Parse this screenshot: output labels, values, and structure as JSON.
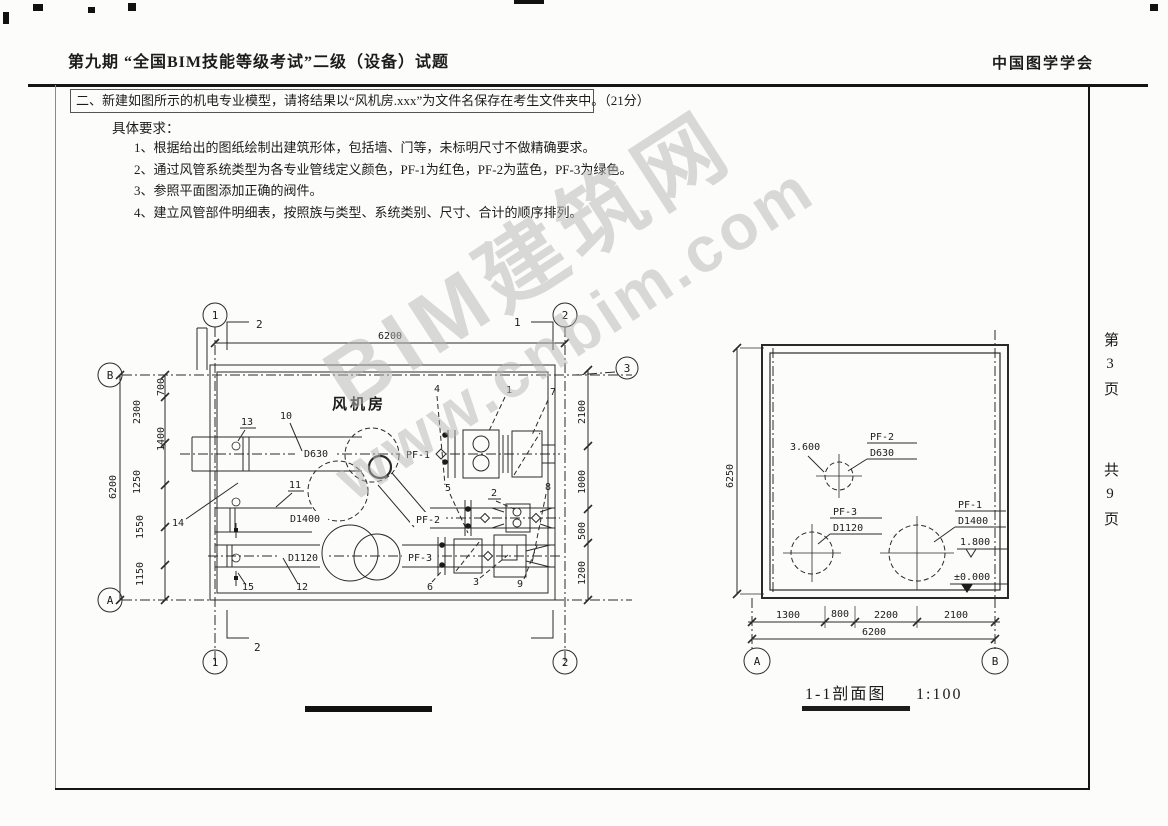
{
  "header": {
    "title": "第九期 “全国BIM技能等级考试”二级（设备）试题",
    "org": "中国图学学会"
  },
  "margin": {
    "page_no": "第3页",
    "total": "共9页"
  },
  "question": {
    "intro": "二、新建如图所示的机电专业模型，请将结果以“风机房.xxx”为文件名保存在考生文件夹中。（21分）",
    "subtitle": "具体要求：",
    "items": [
      "1、根据给出的图纸绘制出建筑形体，包括墙、门等，未标明尺寸不做精确要求。",
      "2、通过风管系统类型为各专业管线定义颜色，PF-1为红色，PF-2为蓝色，PF-3为绿色。",
      "3、参照平面图添加正确的阀件。",
      "4、建立风管部件明细表，按照族与类型、系统类别、尺寸、合计的顺序排列。"
    ]
  },
  "plan": {
    "room_label": "风机房",
    "labels": {
      "d630": "D630",
      "d1400": "D1400",
      "d1120": "D1120",
      "pf1": "PF-1",
      "pf2": "PF-2",
      "pf3": "PF-3"
    },
    "callouts": [
      "1",
      "2",
      "3",
      "4",
      "5",
      "6",
      "7",
      "8",
      "9",
      "10",
      "11",
      "12",
      "13",
      "14",
      "15"
    ],
    "cut_marks": {
      "top_left": "2",
      "top_right": "1",
      "bottom_left": "2"
    },
    "bubbles": {
      "col1": "1",
      "col2": "2",
      "row_b": "B",
      "row_a": "A",
      "row3": "3"
    },
    "dims": {
      "top_overall": "6200",
      "left_overall": "6200",
      "left_chain": [
        "700",
        "2300",
        "1400",
        "1250",
        "1550",
        "1150"
      ],
      "right_chain": [
        "2100",
        "1000",
        "500",
        "1200"
      ]
    }
  },
  "section": {
    "caption": "1-1剖面图",
    "scale": "1:100",
    "tags": {
      "pf2": {
        "name": "PF-2",
        "size": "D630"
      },
      "pf3": {
        "name": "PF-3",
        "size": "D1120"
      },
      "pf1": {
        "name": "PF-1",
        "size": "D1400"
      }
    },
    "levels": {
      "pf2": "3.600",
      "pf1": "1.800",
      "floor": "±0.000"
    },
    "bubbles": {
      "a": "A",
      "b": "B"
    },
    "dims": {
      "bottom_chain": [
        "1300",
        "800",
        "2200",
        "2100"
      ],
      "bottom_overall": "6200",
      "height": "6250"
    }
  },
  "watermark": {
    "line1": "BIM建筑网",
    "line2": "www.cnbim.com"
  }
}
